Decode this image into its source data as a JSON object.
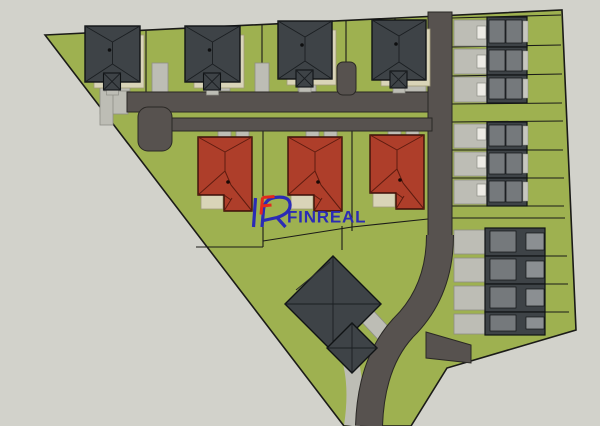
{
  "canvas": {
    "w": 600,
    "h": 426
  },
  "colors": {
    "background": "#d2d2cb",
    "site_green": "#9eb150",
    "road": "#57524f",
    "road_line": "#2a2825",
    "paving": "#bdbdb5",
    "paving_line": "#8e8e86",
    "dark_roof": "#3e4347",
    "dark_roof_line": "#101315",
    "roof_facet_line": "#1b1f22",
    "panel_gray": "#75797c",
    "panel_gray2": "#8b8f92",
    "eave_light": "#c6c6bf",
    "terrace": "#d9d4b8",
    "terrace_line": "#a09a78",
    "red_roof": "#ae3e2a",
    "red_roof_line": "#5e1c10",
    "red_roof_edge": "#3a0f08",
    "plot_line": "#1b1b18",
    "car_white": "#eceae4",
    "logo_blue": "#2b2bb5",
    "logo_red": "#e3291d"
  },
  "site": {
    "outline": [
      [
        45,
        35
      ],
      [
        562,
        10
      ],
      [
        576,
        330
      ],
      [
        447,
        368
      ],
      [
        411,
        426
      ],
      [
        344,
        426
      ]
    ]
  },
  "plots": {
    "lines": [
      [
        146,
        31,
        146,
        92
      ],
      [
        262,
        25,
        262,
        92
      ],
      [
        346,
        21,
        346,
        62
      ],
      [
        395,
        18,
        395,
        92
      ],
      [
        263,
        131,
        263,
        247
      ],
      [
        352,
        131,
        352,
        231
      ],
      [
        196,
        247,
        263,
        247
      ],
      [
        263,
        241,
        352,
        227
      ],
      [
        352,
        227,
        428,
        219
      ],
      [
        342,
        226,
        342,
        250
      ],
      [
        452,
        18,
        561,
        15
      ],
      [
        452,
        47,
        561,
        45
      ],
      [
        452,
        76,
        562,
        74
      ],
      [
        452,
        104,
        562,
        103
      ],
      [
        452,
        122,
        563,
        121
      ],
      [
        452,
        150,
        563,
        150
      ],
      [
        452,
        178,
        564,
        178
      ],
      [
        452,
        206,
        564,
        206
      ],
      [
        452,
        218,
        565,
        218
      ],
      [
        545,
        256,
        567,
        256
      ],
      [
        545,
        284,
        568,
        284
      ],
      [
        545,
        312,
        569,
        312
      ]
    ]
  },
  "paving": {
    "rects": [
      [
        100,
        87,
        28,
        27
      ],
      [
        100,
        87,
        13,
        38
      ],
      [
        104,
        82,
        26,
        9
      ],
      [
        152,
        63,
        16,
        29
      ],
      [
        204,
        82,
        26,
        9
      ],
      [
        255,
        63,
        14,
        29
      ],
      [
        298,
        84,
        18,
        9
      ],
      [
        396,
        84,
        30,
        9
      ],
      [
        218,
        130,
        13,
        9
      ],
      [
        236,
        130,
        13,
        9
      ],
      [
        306,
        130,
        13,
        9
      ],
      [
        324,
        130,
        13,
        9
      ],
      [
        388,
        128,
        13,
        9
      ],
      [
        406,
        128,
        13,
        9
      ],
      [
        454,
        20,
        33,
        26
      ],
      [
        454,
        49,
        33,
        25
      ],
      [
        454,
        77,
        33,
        25
      ],
      [
        454,
        124,
        33,
        24
      ],
      [
        454,
        152,
        33,
        24
      ],
      [
        454,
        180,
        33,
        24
      ],
      [
        454,
        230,
        31,
        24
      ],
      [
        454,
        258,
        31,
        24
      ],
      [
        454,
        286,
        31,
        24
      ],
      [
        454,
        314,
        31,
        20
      ]
    ],
    "polys": [
      [
        [
          357,
          317
        ],
        [
          369,
          306
        ],
        [
          398,
          337
        ],
        [
          386,
          348
        ]
      ]
    ],
    "paths": [
      {
        "d": "M342,340 Q360,372 352,426",
        "w": 16
      }
    ]
  },
  "roads": {
    "rects": [
      [
        127,
        92,
        305,
        20
      ],
      [
        428,
        12,
        24,
        229
      ],
      [
        152,
        118,
        280,
        13
      ]
    ],
    "rounded": [
      [
        138,
        107,
        34,
        44,
        10
      ],
      [
        337,
        62,
        19,
        33,
        6
      ]
    ],
    "paths": [
      {
        "d": "M440,235 Q440,292 403,328 Q371,363 369,426",
        "w": 26
      }
    ],
    "polys": [
      [
        [
          426,
          332
        ],
        [
          471,
          345
        ],
        [
          471,
          363
        ],
        [
          426,
          358
        ]
      ]
    ]
  },
  "buildings": {
    "dark_houses": [
      [
        85,
        26,
        55,
        56
      ],
      [
        185,
        26,
        55,
        56
      ],
      [
        278,
        21,
        54,
        58
      ],
      [
        372,
        20,
        54,
        60
      ]
    ],
    "red_houses": [
      [
        198,
        137
      ],
      [
        288,
        137
      ],
      [
        370,
        135
      ]
    ],
    "red_size": {
      "w": 54,
      "h": 74
    },
    "townhouse_units": [
      [
        487,
        17,
        40,
        30
      ],
      [
        487,
        47,
        40,
        28
      ],
      [
        487,
        75,
        40,
        28
      ],
      [
        487,
        122,
        40,
        28
      ],
      [
        487,
        150,
        40,
        28
      ],
      [
        487,
        178,
        40,
        28
      ]
    ],
    "cluster_units": [
      [
        485,
        228,
        60,
        28
      ],
      [
        485,
        256,
        60,
        28
      ],
      [
        485,
        284,
        60,
        28
      ],
      [
        485,
        312,
        60,
        23
      ]
    ],
    "community": {
      "diamonds": [
        [
          333,
          304,
          48
        ],
        [
          352,
          348,
          25
        ]
      ],
      "fence": [
        296,
        290,
        330,
        262
      ]
    },
    "cars": [
      [
        477,
        26,
        9,
        13
      ],
      [
        477,
        55,
        9,
        13
      ],
      [
        477,
        83,
        9,
        13
      ],
      [
        477,
        128,
        9,
        12
      ],
      [
        477,
        156,
        9,
        12
      ],
      [
        477,
        184,
        9,
        12
      ]
    ]
  },
  "logo": {
    "text": "FINREAL"
  }
}
